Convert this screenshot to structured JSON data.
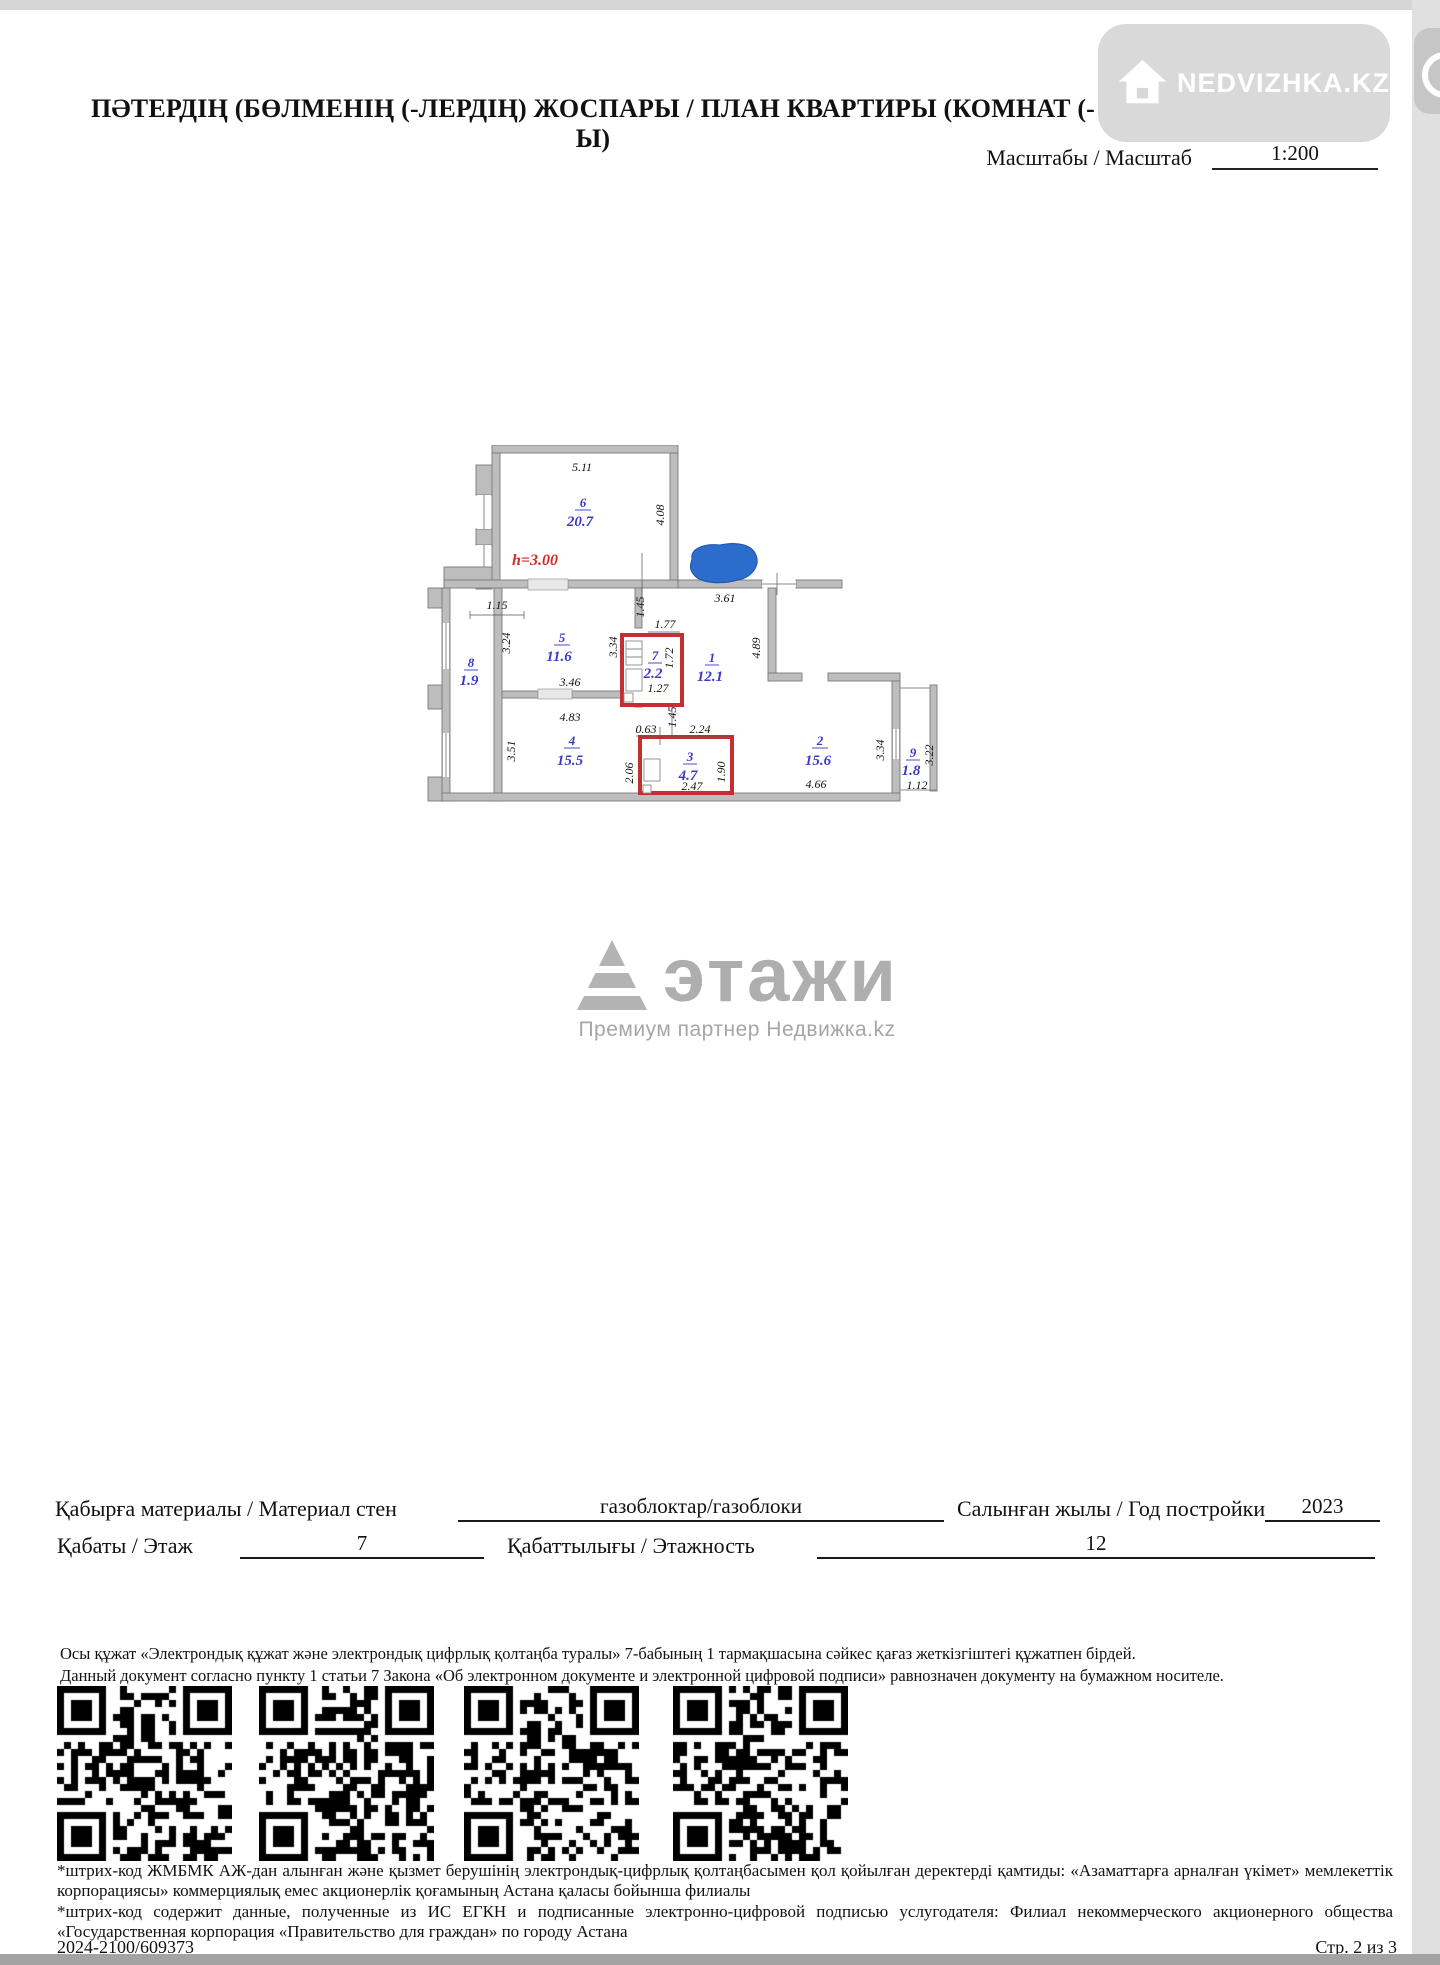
{
  "header": {
    "title": "ПӘТЕРДІҢ (БӨЛМЕНІҢ (-ЛЕРДІҢ) ЖОСПАРЫ / ПЛАН КВАРТИРЫ (КОМНАТ (-Ы)",
    "scale_label": "Масштабы / Масштаб",
    "scale_value": "1:200"
  },
  "watermarks": {
    "nedvizhka": "NEDVIZHKA.KZ",
    "etagi_word": "этажи",
    "etagi_subtitle": "Премиум партнер Недвижка.kz"
  },
  "floor_plan": {
    "height_note": "h=3.00",
    "rooms": {
      "r6": {
        "num": "6",
        "area": "20.7"
      },
      "r5": {
        "num": "5",
        "area": "11.6"
      },
      "r8": {
        "num": "8",
        "area": "1.9"
      },
      "r7": {
        "num": "7",
        "area": "2.2"
      },
      "r1": {
        "num": "1",
        "area": "12.1"
      },
      "r4": {
        "num": "4",
        "area": "15.5"
      },
      "r3": {
        "num": "3",
        "area": "4.7"
      },
      "r2": {
        "num": "2",
        "area": "15.6"
      },
      "r9": {
        "num": "9",
        "area": "1.8"
      }
    },
    "dims": {
      "d511": "5.11",
      "d408": "4.08",
      "d115": "1.15",
      "d324": "3.24",
      "d145a": "1.45",
      "d361": "3.61",
      "d177": "1.77",
      "d334a": "3.34",
      "d172": "1.72",
      "d127": "1.27",
      "d346": "3.46",
      "d489": "4.89",
      "d483": "4.83",
      "d063": "0.63",
      "d224": "2.24",
      "d145b": "1.45",
      "d351": "3.51",
      "d206": "2.06",
      "d190": "1.90",
      "d247": "2.47",
      "d466": "4.66",
      "d334b": "3.34",
      "d322": "3.22",
      "d112": "1.12"
    }
  },
  "form": {
    "wall_label": "Қабырға материалы / Материал стен",
    "wall_value": "газоблоктар/газоблоки",
    "year_label": "Салынған жылы / Год постройки",
    "year_value": "2023",
    "floor_label": "Қабаты / Этаж",
    "floor_value": "7",
    "floors_label": "Қабаттылығы / Этажность",
    "floors_value": "12"
  },
  "legal": {
    "line_kk": "Осы құжат «Электрондық құжат және электрондық цифрлық қолтаңба туралы» 7-бабының 1 тармақшасына сәйкес қағаз жеткізгіштегі құжатпен бірдей.",
    "line_ru": "Данный документ согласно пункту 1 статьи 7 Закона «Об электронном документе и электронной цифровой подписи» равнозначен документу на бумажном носителе."
  },
  "barcode_notes": {
    "note_kk": "*штрих-код ЖМБМК АЖ-дан алынған және қызмет берушінің электрондық-цифрлық қолтаңбасымен қол қойылған деректерді қамтиды: «Азаматтарға арналған үкімет» мемлекеттік корпорациясы» коммерциялық емес акционерлік қоғамының Астана қаласы бойынша филиалы",
    "note_ru": "*штрих-код содержит данные, полученные из ИС ЕГКН и подписанные электронно-цифровой подписью услугодателя: Филиал некоммерческого акционерного общества «Государственная корпорация «Правительство для граждан» по городу Астана"
  },
  "footer": {
    "doc_number": "2024-2100/609373",
    "page": "Стр. 2 из 3"
  },
  "colors": {
    "room_label_blue": "#3a3ac8",
    "wet_wall_red": "#c43030",
    "height_note_red": "#d42b2b",
    "redaction_blue": "#2b6ccd",
    "wall_gray": "#bdbdbd"
  }
}
